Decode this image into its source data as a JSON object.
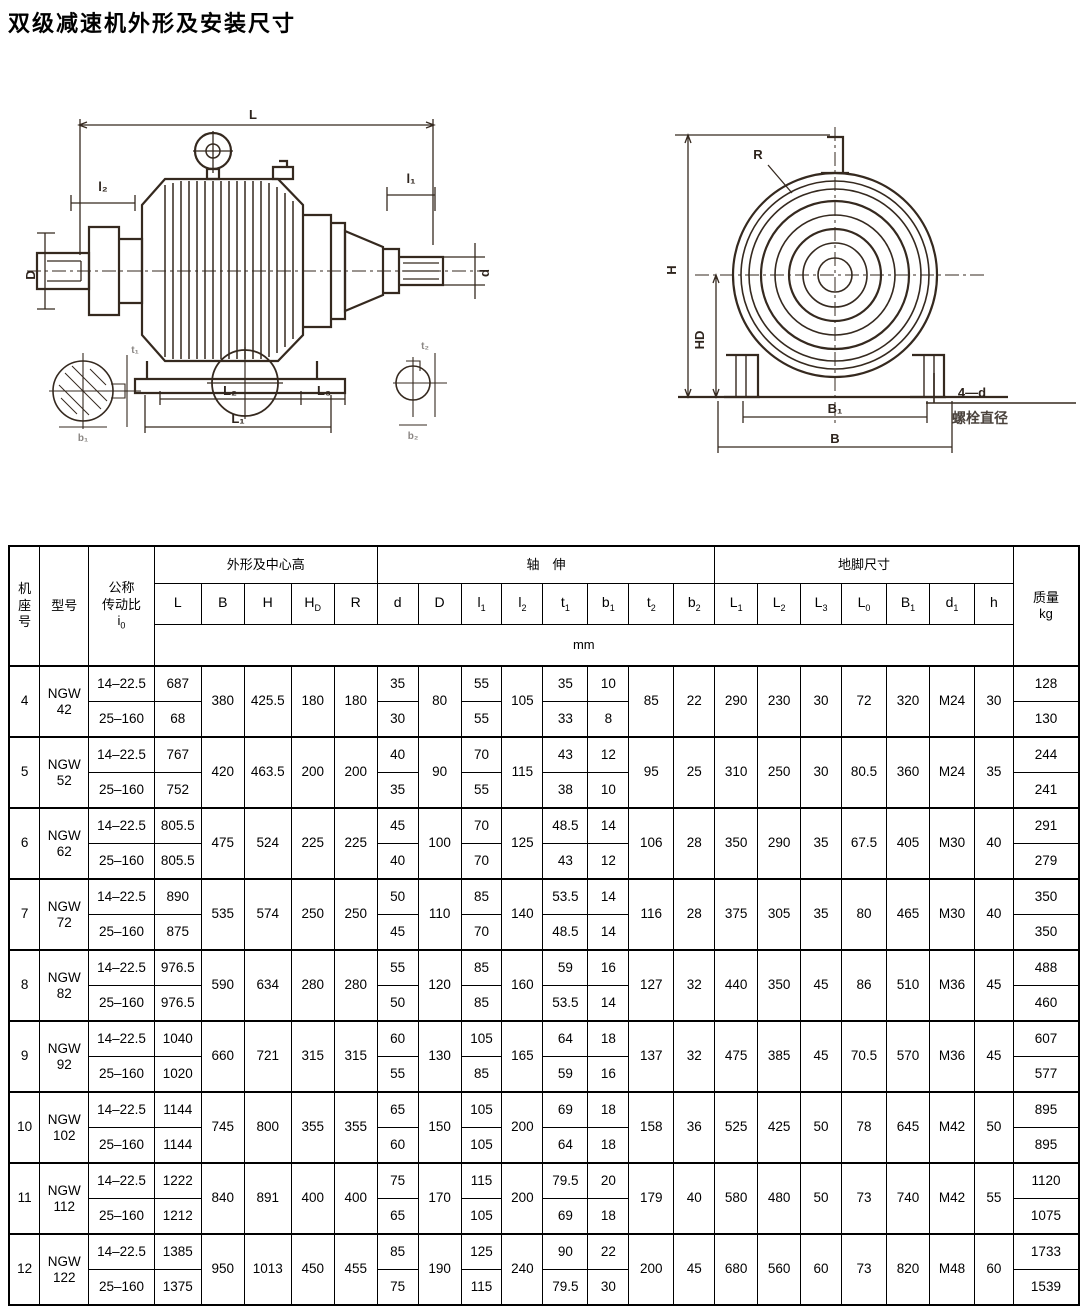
{
  "page": {
    "title": "双级减速机外形及安装尺寸"
  },
  "figures": {
    "left": {
      "labels": {
        "L": "L",
        "l2": "l₂",
        "D": "D",
        "l1": "l₁",
        "d": "d",
        "L2": "L₂",
        "L3": "L₃",
        "L1": "L₁",
        "t1": "t₁",
        "b1": "b₁",
        "t2": "t₂",
        "b2": "b₂"
      }
    },
    "right": {
      "labels": {
        "R": "R",
        "H": "H",
        "HD": "HD",
        "B1": "B₁",
        "B": "B",
        "bolt_count": "4—d",
        "bolt_note": "螺栓直径"
      }
    }
  },
  "table": {
    "header": {
      "frame": "机座号",
      "model": "型号",
      "ratio_l1": "公称",
      "ratio_l2": "传动比",
      "ratio_i_base": "i",
      "ratio_i_sub": "0",
      "group_outline": "外形及中心高",
      "group_shaft": "轴　伸",
      "group_foot": "地脚尺寸",
      "mass_l1": "质量",
      "mass_l2": "kg",
      "unit": "mm",
      "columns": [
        {
          "base": "L",
          "sub": ""
        },
        {
          "base": "B",
          "sub": ""
        },
        {
          "base": "H",
          "sub": ""
        },
        {
          "base": "H",
          "sub": "D"
        },
        {
          "base": "R",
          "sub": ""
        },
        {
          "base": "d",
          "sub": ""
        },
        {
          "base": "D",
          "sub": ""
        },
        {
          "base": "l",
          "sub": "1"
        },
        {
          "base": "l",
          "sub": "2"
        },
        {
          "base": "t",
          "sub": "1"
        },
        {
          "base": "b",
          "sub": "1"
        },
        {
          "base": "t",
          "sub": "2"
        },
        {
          "base": "b",
          "sub": "2"
        },
        {
          "base": "L",
          "sub": "1"
        },
        {
          "base": "L",
          "sub": "2"
        },
        {
          "base": "L",
          "sub": "3"
        },
        {
          "base": "L",
          "sub": "0"
        },
        {
          "base": "B",
          "sub": "1"
        },
        {
          "base": "d",
          "sub": "1"
        },
        {
          "base": "h",
          "sub": ""
        }
      ]
    },
    "groups": [
      {
        "frame": "4",
        "model_line1": "NGW",
        "model_line2": "42",
        "rows": [
          {
            "ratio": "14–22.5",
            "L": "687",
            "d": "35",
            "l1": "55",
            "t1": "35",
            "b1": "10",
            "kg": "128"
          },
          {
            "ratio": "25–160",
            "L": "68",
            "d": "30",
            "l1": "55",
            "t1": "33",
            "b1": "8",
            "kg": "130"
          }
        ],
        "B": "380",
        "H": "425.5",
        "HD": "180",
        "R": "180",
        "D": "80",
        "l2": "105",
        "t2": "85",
        "b2": "22",
        "L1": "290",
        "L2": "230",
        "L3": "30",
        "L0": "72",
        "B1": "320",
        "d1": "M24",
        "h": "30"
      },
      {
        "frame": "5",
        "model_line1": "NGW",
        "model_line2": "52",
        "rows": [
          {
            "ratio": "14–22.5",
            "L": "767",
            "d": "40",
            "l1": "70",
            "t1": "43",
            "b1": "12",
            "kg": "244"
          },
          {
            "ratio": "25–160",
            "L": "752",
            "d": "35",
            "l1": "55",
            "t1": "38",
            "b1": "10",
            "kg": "241"
          }
        ],
        "B": "420",
        "H": "463.5",
        "HD": "200",
        "R": "200",
        "D": "90",
        "l2": "115",
        "t2": "95",
        "b2": "25",
        "L1": "310",
        "L2": "250",
        "L3": "30",
        "L0": "80.5",
        "B1": "360",
        "d1": "M24",
        "h": "35"
      },
      {
        "frame": "6",
        "model_line1": "NGW",
        "model_line2": "62",
        "rows": [
          {
            "ratio": "14–22.5",
            "L": "805.5",
            "d": "45",
            "l1": "70",
            "t1": "48.5",
            "b1": "14",
            "kg": "291"
          },
          {
            "ratio": "25–160",
            "L": "805.5",
            "d": "40",
            "l1": "70",
            "t1": "43",
            "b1": "12",
            "kg": "279"
          }
        ],
        "B": "475",
        "H": "524",
        "HD": "225",
        "R": "225",
        "D": "100",
        "l2": "125",
        "t2": "106",
        "b2": "28",
        "L1": "350",
        "L2": "290",
        "L3": "35",
        "L0": "67.5",
        "B1": "405",
        "d1": "M30",
        "h": "40"
      },
      {
        "frame": "7",
        "model_line1": "NGW",
        "model_line2": "72",
        "rows": [
          {
            "ratio": "14–22.5",
            "L": "890",
            "d": "50",
            "l1": "85",
            "t1": "53.5",
            "b1": "14",
            "kg": "350"
          },
          {
            "ratio": "25–160",
            "L": "875",
            "d": "45",
            "l1": "70",
            "t1": "48.5",
            "b1": "14",
            "kg": "350"
          }
        ],
        "B": "535",
        "H": "574",
        "HD": "250",
        "R": "250",
        "D": "110",
        "l2": "140",
        "t2": "116",
        "b2": "28",
        "L1": "375",
        "L2": "305",
        "L3": "35",
        "L0": "80",
        "B1": "465",
        "d1": "M30",
        "h": "40"
      },
      {
        "frame": "8",
        "model_line1": "NGW",
        "model_line2": "82",
        "rows": [
          {
            "ratio": "14–22.5",
            "L": "976.5",
            "d": "55",
            "l1": "85",
            "t1": "59",
            "b1": "16",
            "kg": "488"
          },
          {
            "ratio": "25–160",
            "L": "976.5",
            "d": "50",
            "l1": "85",
            "t1": "53.5",
            "b1": "14",
            "kg": "460"
          }
        ],
        "B": "590",
        "H": "634",
        "HD": "280",
        "R": "280",
        "D": "120",
        "l2": "160",
        "t2": "127",
        "b2": "32",
        "L1": "440",
        "L2": "350",
        "L3": "45",
        "L0": "86",
        "B1": "510",
        "d1": "M36",
        "h": "45"
      },
      {
        "frame": "9",
        "model_line1": "NGW",
        "model_line2": "92",
        "rows": [
          {
            "ratio": "14–22.5",
            "L": "1040",
            "d": "60",
            "l1": "105",
            "t1": "64",
            "b1": "18",
            "kg": "607"
          },
          {
            "ratio": "25–160",
            "L": "1020",
            "d": "55",
            "l1": "85",
            "t1": "59",
            "b1": "16",
            "kg": "577"
          }
        ],
        "B": "660",
        "H": "721",
        "HD": "315",
        "R": "315",
        "D": "130",
        "l2": "165",
        "t2": "137",
        "b2": "32",
        "L1": "475",
        "L2": "385",
        "L3": "45",
        "L0": "70.5",
        "B1": "570",
        "d1": "M36",
        "h": "45"
      },
      {
        "frame": "10",
        "model_line1": "NGW",
        "model_line2": "102",
        "rows": [
          {
            "ratio": "14–22.5",
            "L": "1144",
            "d": "65",
            "l1": "105",
            "t1": "69",
            "b1": "18",
            "kg": "895"
          },
          {
            "ratio": "25–160",
            "L": "1144",
            "d": "60",
            "l1": "105",
            "t1": "64",
            "b1": "18",
            "kg": "895"
          }
        ],
        "B": "745",
        "H": "800",
        "HD": "355",
        "R": "355",
        "D": "150",
        "l2": "200",
        "t2": "158",
        "b2": "36",
        "L1": "525",
        "L2": "425",
        "L3": "50",
        "L0": "78",
        "B1": "645",
        "d1": "M42",
        "h": "50"
      },
      {
        "frame": "11",
        "model_line1": "NGW",
        "model_line2": "112",
        "rows": [
          {
            "ratio": "14–22.5",
            "L": "1222",
            "d": "75",
            "l1": "115",
            "t1": "79.5",
            "b1": "20",
            "kg": "1120"
          },
          {
            "ratio": "25–160",
            "L": "1212",
            "d": "65",
            "l1": "105",
            "t1": "69",
            "b1": "18",
            "kg": "1075"
          }
        ],
        "B": "840",
        "H": "891",
        "HD": "400",
        "R": "400",
        "D": "170",
        "l2": "200",
        "t2": "179",
        "b2": "40",
        "L1": "580",
        "L2": "480",
        "L3": "50",
        "L0": "73",
        "B1": "740",
        "d1": "M42",
        "h": "55"
      },
      {
        "frame": "12",
        "model_line1": "NGW",
        "model_line2": "122",
        "rows": [
          {
            "ratio": "14–22.5",
            "L": "1385",
            "d": "85",
            "l1": "125",
            "t1": "90",
            "b1": "22",
            "kg": "1733"
          },
          {
            "ratio": "25–160",
            "L": "1375",
            "d": "75",
            "l1": "115",
            "t1": "79.5",
            "b1": "30",
            "kg": "1539"
          }
        ],
        "B": "950",
        "H": "1013",
        "HD": "450",
        "R": "455",
        "D": "190",
        "l2": "240",
        "t2": "200",
        "b2": "45",
        "L1": "680",
        "L2": "560",
        "L3": "60",
        "L0": "73",
        "B1": "820",
        "d1": "M48",
        "h": "60"
      }
    ]
  }
}
